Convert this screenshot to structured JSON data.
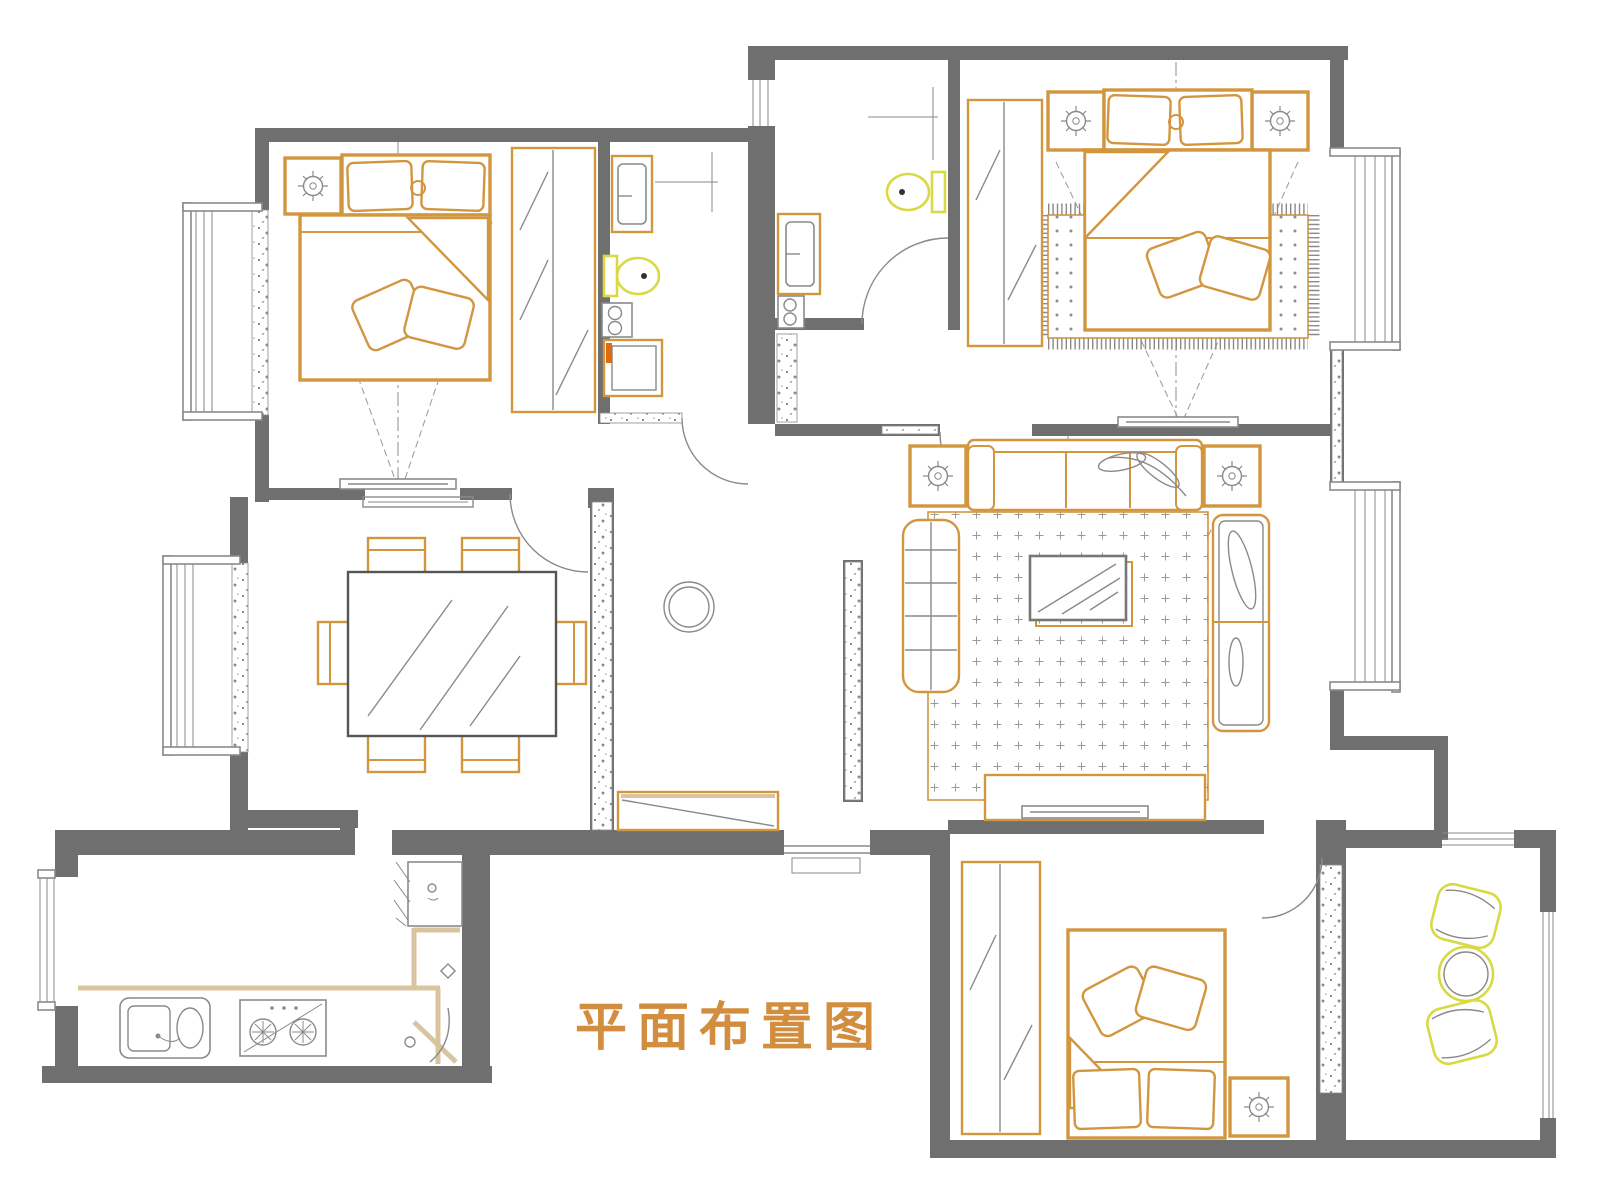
{
  "title": {
    "text": "平面布置图"
  },
  "colors": {
    "paper": "#ffffff",
    "wall": "#6f6f6f",
    "furn": "#d2963f",
    "furn2": "#c07a20",
    "fixture": "#d9d945",
    "counter": "#d8c49e",
    "gray": "#8a8a8a",
    "dash": "#a0a0a0",
    "title": "#d28e3e",
    "accent": "#e06a10"
  },
  "scene": {
    "type": "residential-floor-plan",
    "rooms": [
      {
        "name": "bedroom-top-left",
        "furniture": [
          "double-bed",
          "pillows",
          "nightstand-with-lamp",
          "wardrobe",
          "tv-on-wall",
          "bay-window",
          "door"
        ]
      },
      {
        "name": "bathroom-center-left",
        "furniture": [
          "wash-basin",
          "toilet",
          "washer-drum",
          "shower-cabinet",
          "door"
        ]
      },
      {
        "name": "master-bathroom-top-center",
        "furniture": [
          "wash-basin",
          "toilet",
          "window",
          "door"
        ]
      },
      {
        "name": "master-bedroom-top-right",
        "furniture": [
          "double-bed",
          "pillows",
          "two-nightstands-with-lamps",
          "wardrobe",
          "area-rug-with-fringe",
          "tv-on-wall",
          "bay-window",
          "door"
        ]
      },
      {
        "name": "living-room-right",
        "furniture": [
          "three-seat-sofa",
          "plant-decor",
          "two-side-tables-with-lamps",
          "bench-chaise",
          "loveseat",
          "glass-coffee-table",
          "dotted-rug",
          "tv-cabinet",
          "television",
          "bay-window"
        ]
      },
      {
        "name": "dining-room-left",
        "furniture": [
          "dining-table",
          "six-chairs",
          "bay-window",
          "threshold"
        ]
      },
      {
        "name": "kitchen-bottom-left",
        "furniture": [
          "counter",
          "double-sink",
          "gas-stove",
          "refrigerator",
          "window"
        ]
      },
      {
        "name": "bedroom-bottom-right",
        "furniture": [
          "bed",
          "pillows",
          "nightstand-with-lamp",
          "wardrobe",
          "door"
        ]
      },
      {
        "name": "balcony-bottom-right",
        "furniture": [
          "two-leisure-chairs",
          "round-table",
          "windows"
        ]
      },
      {
        "name": "hallway-center",
        "furniture": [
          "decor-circle",
          "shoe-cabinet",
          "entrance-threshold"
        ]
      }
    ]
  }
}
